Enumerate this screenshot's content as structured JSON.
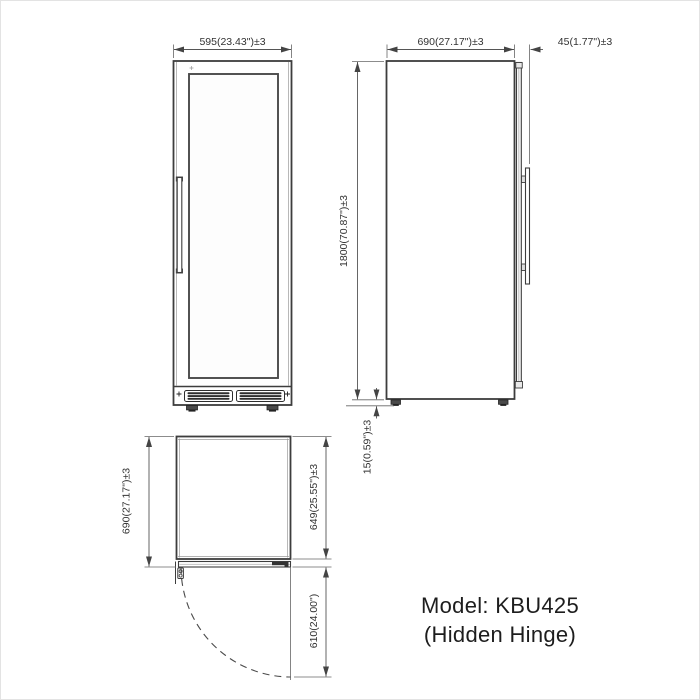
{
  "diagram": {
    "product": {
      "title_line1": "Model: KBU425",
      "title_line2": "(Hidden Hinge)"
    },
    "front_view": {
      "width": "595(23.43\")±3"
    },
    "side_view": {
      "depth": "690(27.17\")±3",
      "door_thickness": "45(1.77\")±3",
      "height": "1800(70.87\")±3",
      "foot_height": "15(0.59\")±3"
    },
    "top_view": {
      "depth_with_door": "690(27.17\")±3",
      "cabinet_depth": "649(25.55\")±3",
      "door_swing": "610(24.00\")"
    },
    "colors": {
      "background": "#ffffff",
      "outline": "#3d3d3d",
      "dimension_lines": "#555555",
      "dimension_text": "#333333",
      "model_text": "#1d1d1d"
    }
  }
}
